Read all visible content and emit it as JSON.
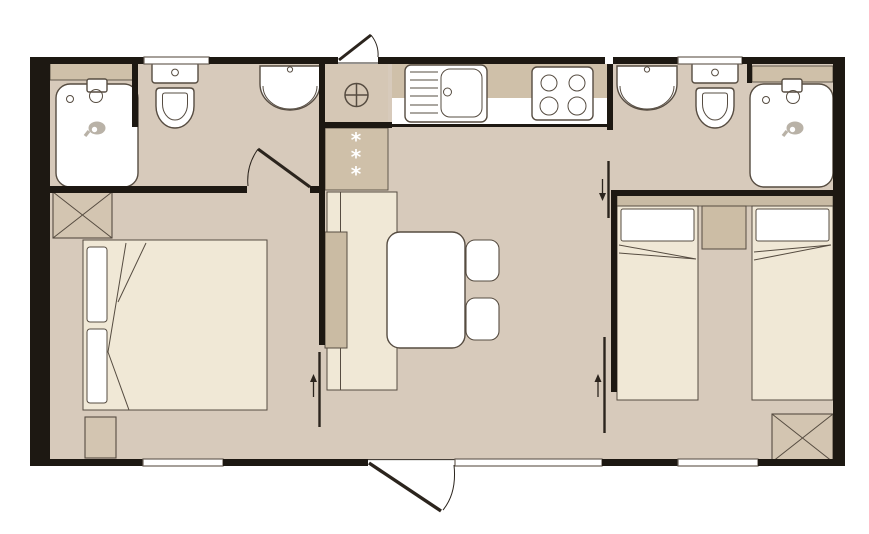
{
  "palette": {
    "paper": "#ffffff",
    "wall": "#1d1812",
    "floor": "#d7cabb",
    "furn_light": "#f0e8d6",
    "outline": "#564c41",
    "line_dark": "#2b241d",
    "wardrobe": "#d3c5b1",
    "counter": "#cfc0a9",
    "headboard": "#c9bba4",
    "nightstand": "#ccbda5",
    "backrest": "#cabba3",
    "heater_square": "#d5c7b5",
    "icon_gray": "#b9b2a7",
    "window_line": "#6b6258"
  },
  "floorplan": {
    "type": "mobile-home two-bedroom floor plan, top-down view",
    "closet": {
      "symbols": [
        "*",
        "*",
        "*"
      ]
    },
    "rooms": {
      "bathroom_left": {
        "fixtures": [
          "bathtub-shower",
          "toilet",
          "washbasin",
          "shelf",
          "hinged-door"
        ]
      },
      "kitchen": {
        "fixtures": [
          "water-heater-symbol",
          "sink-with-drainer",
          "hob-4-burners",
          "counter",
          "closet-3-stars"
        ]
      },
      "bathroom_right": {
        "fixtures": [
          "washbasin",
          "toilet",
          "shower-cabin",
          "shelf",
          "sliding-door"
        ]
      },
      "bedroom_left": {
        "fixtures": [
          "double-bed",
          "two-pillows",
          "wardrobe-x",
          "low-cabinet",
          "sliding-door"
        ]
      },
      "living_room": {
        "fixtures": [
          "bench-seat",
          "table",
          "chair",
          "chair",
          "entrance-door"
        ]
      },
      "bedroom_right": {
        "fixtures": [
          "single-bed",
          "single-bed",
          "nightstand",
          "headboard",
          "wardrobe-x",
          "sliding-door"
        ]
      }
    },
    "exterior": {
      "windows": 5,
      "doors": 2
    }
  }
}
